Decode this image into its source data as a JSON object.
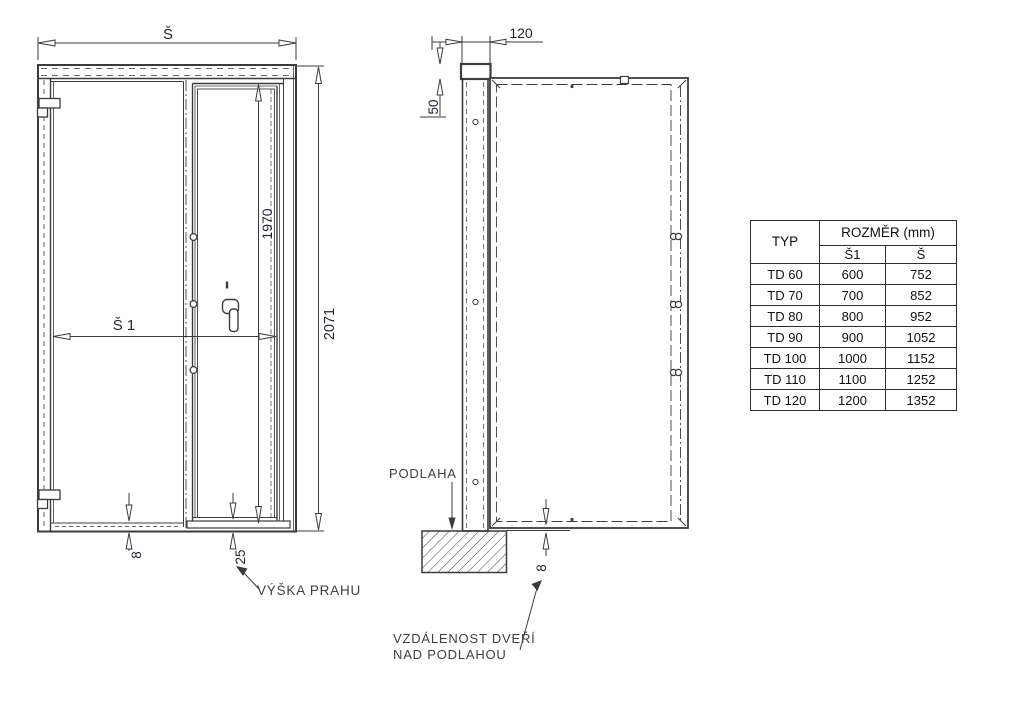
{
  "front_view": {
    "width_dim": "Š",
    "clear_width_dim": "Š 1",
    "leaf_height_dim": "1970",
    "total_height_dim": "2071",
    "bottom_gap_dim": "8",
    "threshold_dim": "25",
    "threshold_label": "VÝŠKA PRAHU"
  },
  "side_view": {
    "frame_depth_dim": "120",
    "top_offset_dim": "50",
    "floor_label": "PODLAHA",
    "floor_gap_dim": "8",
    "floor_gap_label_line1": "VZDÁLENOST DVEŘÍ",
    "floor_gap_label_line2": "NAD PODLAHOU"
  },
  "size_table": {
    "header_type": "TYP",
    "header_dimension": "ROZMĚR (mm)",
    "header_s1": "Š1",
    "header_s": "Š",
    "rows": [
      {
        "type": "TD 60",
        "s1": "600",
        "s": "752"
      },
      {
        "type": "TD 70",
        "s1": "700",
        "s": "852"
      },
      {
        "type": "TD 80",
        "s1": "800",
        "s": "952"
      },
      {
        "type": "TD 90",
        "s1": "900",
        "s": "1052"
      },
      {
        "type": "TD 100",
        "s1": "1000",
        "s": "1152"
      },
      {
        "type": "TD 110",
        "s1": "1100",
        "s": "1252"
      },
      {
        "type": "TD 120",
        "s1": "1200",
        "s": "1352"
      }
    ]
  },
  "colors": {
    "line": "#3c3c3c",
    "dim_text": "#1f2433",
    "table_border": "#2e2e2e",
    "background": "#ffffff"
  }
}
